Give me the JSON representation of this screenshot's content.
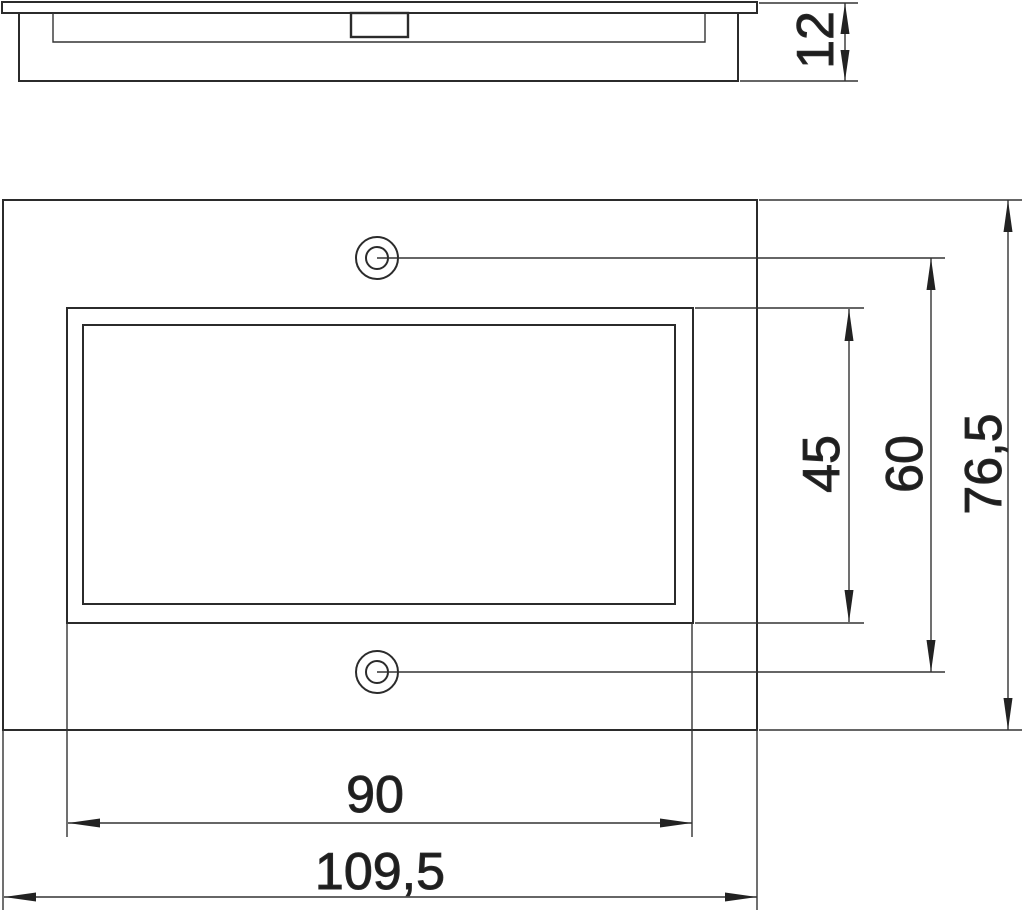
{
  "drawing": {
    "background": "#ffffff",
    "line_color": "#2b2b2b",
    "side_view": {
      "thickness": "12"
    },
    "front_view": {
      "cutout_height": "45",
      "hole_spacing": "60",
      "overall_height": "76,5",
      "cutout_width": "90",
      "overall_width": "109,5"
    }
  }
}
